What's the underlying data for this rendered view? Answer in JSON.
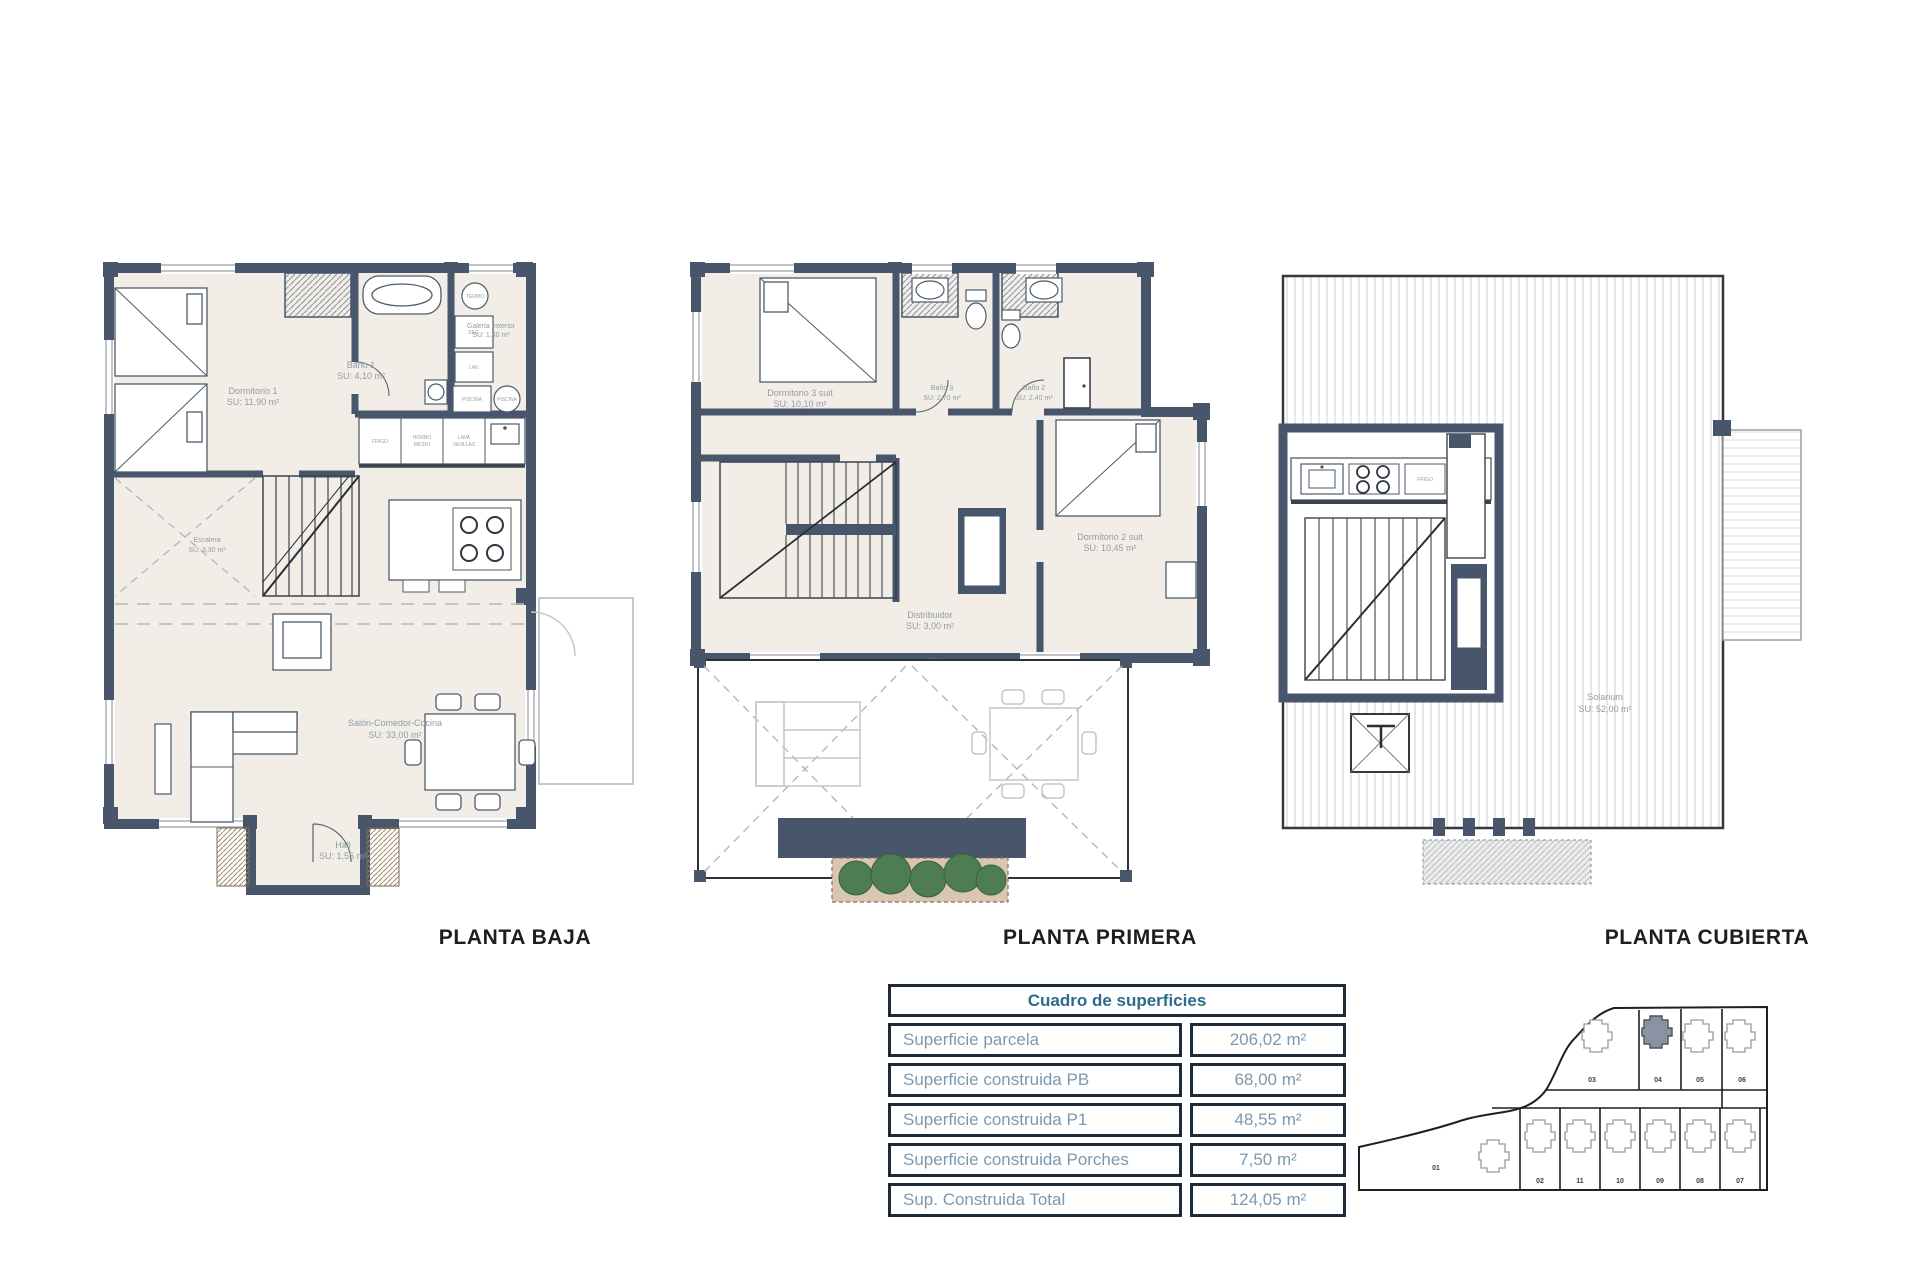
{
  "document": {
    "background": "#ffffff"
  },
  "colors": {
    "wall": "#47566b",
    "floor": "#f2eee7",
    "furniture_line": "#4e5a68",
    "label_text": "#8f9da6",
    "table_border": "#1d2b39",
    "table_text": "#7d98ad",
    "table_header_text": "#2d6a8f",
    "title_text": "#1e1e1c",
    "plant_green": "#4e7d54",
    "planter_tan": "#d9c6ae",
    "highlight_plot": "#8a93a3"
  },
  "plans": [
    {
      "id": "planta_baja",
      "title": "PLANTA BAJA",
      "rooms": [
        {
          "name": "Dormitorio 1",
          "area": "SU: 11,90 m²"
        },
        {
          "name": "Baño 1",
          "area": "SU: 4,10 m²"
        },
        {
          "name": "Galería exterior",
          "area": "SU: 1,40 m²"
        },
        {
          "name": "Escalera",
          "area": "SU: 3,30 m²"
        },
        {
          "name": "Salón-Comedor-Cocina",
          "area": "SU: 33,00 m²"
        },
        {
          "name": "Hall",
          "area": "SU: 1,55 m²"
        }
      ],
      "appliances": {
        "frigo": "FRIGO",
        "horno_l1": "HORNO",
        "horno_l2": "MICRO",
        "lava_l1": "LAVA",
        "lava_l2": "VAJILLAS",
        "termo": "TERMO",
        "sec": "SEC.",
        "lav": "LAV.",
        "piscina": "PISCINA"
      }
    },
    {
      "id": "planta_primera",
      "title": "PLANTA PRIMERA",
      "rooms": [
        {
          "name": "Dormitorio 3 suit",
          "area": "SU: 10,10 m²"
        },
        {
          "name": "Baño 3",
          "area": "SU: 2,70 m²"
        },
        {
          "name": "Baño 2",
          "area": "SU: 2,40 m²"
        },
        {
          "name": "Distribuidor",
          "area": "SU: 3,00 m²"
        },
        {
          "name": "Dormitorio 2 suit",
          "area": "SU: 10,45 m²"
        }
      ]
    },
    {
      "id": "planta_cubierta",
      "title": "PLANTA CUBIERTA",
      "rooms": [
        {
          "name": "Solarium",
          "area": "SU: 52,00 m²"
        }
      ],
      "appliances": {
        "frigo": "FRIGO"
      }
    }
  ],
  "surface_table": {
    "title": "Cuadro de superficies",
    "rows": [
      {
        "label": "Superficie parcela",
        "value": "206,02 m²"
      },
      {
        "label": "Superficie construida PB",
        "value": "68,00 m²"
      },
      {
        "label": "Superficie construida P1",
        "value": "48,55 m²"
      },
      {
        "label": "Superficie construida Porches",
        "value": "7,50 m²"
      },
      {
        "label": "Sup. Construida Total",
        "value": "124,05 m²"
      }
    ]
  },
  "site_plan": {
    "top_plots": [
      "03",
      "04",
      "05",
      "06"
    ],
    "bottom_plots": [
      "01",
      "02",
      "11",
      "10",
      "09",
      "08",
      "07"
    ],
    "highlighted_plot": "04"
  }
}
